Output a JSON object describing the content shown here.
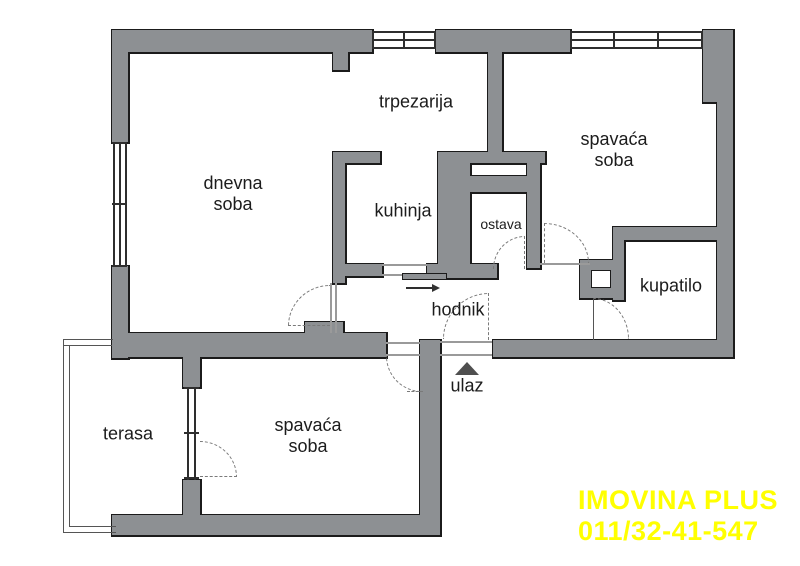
{
  "floorplan": {
    "title": "apartment floor plan",
    "wall_color": "#8d9093",
    "outline_color": "#1b1b1b",
    "background_color": "#ffffff",
    "rooms": [
      {
        "id": "trpezarija",
        "line1": "trpezarija",
        "line2": ""
      },
      {
        "id": "dnevna-soba",
        "line1": "dnevna",
        "line2": "soba"
      },
      {
        "id": "kuhinja",
        "line1": "kuhinja",
        "line2": ""
      },
      {
        "id": "ostava",
        "line1": "ostava",
        "line2": ""
      },
      {
        "id": "spavaca-soba-gore",
        "line1": "spavaća",
        "line2": "soba"
      },
      {
        "id": "kupatilo",
        "line1": "kupatilo",
        "line2": ""
      },
      {
        "id": "hodnik",
        "line1": "hodnik",
        "line2": ""
      },
      {
        "id": "terasa",
        "line1": "terasa",
        "line2": ""
      },
      {
        "id": "spavaca-soba-dole",
        "line1": "spavaća",
        "line2": "soba"
      }
    ],
    "entrance": {
      "label": "ulaz"
    },
    "watermark": {
      "line1": "IMOVINA PLUS",
      "line2": "011/32-41-547",
      "color": "#ffff00"
    }
  }
}
